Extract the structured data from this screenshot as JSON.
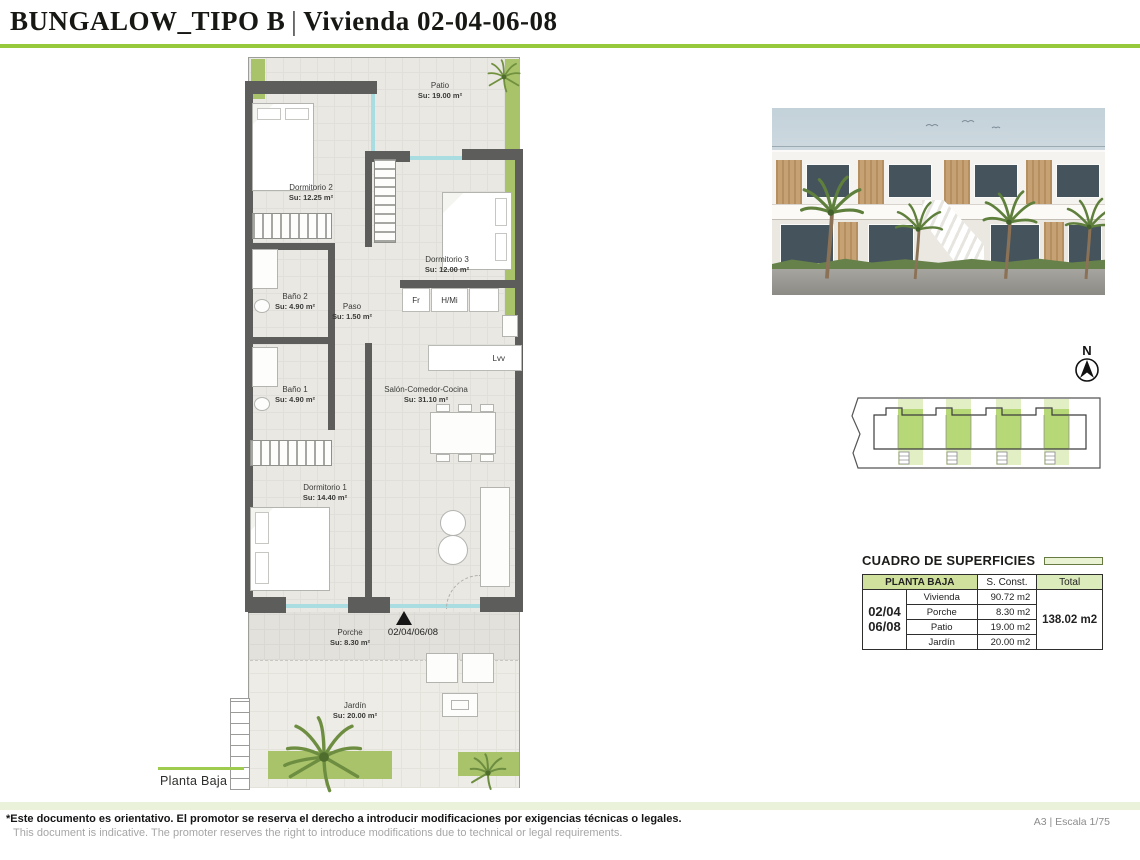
{
  "header": {
    "title_main": "BUNGALOW_TIPO B",
    "title_divider": "|",
    "title_sub": "Vivienda 02-04-06-08"
  },
  "plan": {
    "floor_label": "Planta Baja",
    "entrance_label": "02/04/06/08",
    "north_label": "N",
    "rooms": [
      {
        "name": "Patio",
        "area": "Su: 19.00 m²"
      },
      {
        "name": "Dormitorio 2",
        "area": "Su: 12.25 m²"
      },
      {
        "name": "Dormitorio 3",
        "area": "Su: 12.00 m²"
      },
      {
        "name": "Baño 2",
        "area": "Su: 4.90 m²"
      },
      {
        "name": "Paso",
        "area": "Su: 1.50 m²"
      },
      {
        "name": "Baño 1",
        "area": "Su: 4.90 m²"
      },
      {
        "name": "Salón-Comedor-Cocina",
        "area": "Su: 31.10 m²"
      },
      {
        "name": "Dormitorio 1",
        "area": "Su: 14.40 m²"
      },
      {
        "name": "Porche",
        "area": "Su: 8.30 m²"
      },
      {
        "name": "Jardín",
        "area": "Su: 20.00 m²"
      }
    ],
    "kitchen": {
      "fridge": "Fr",
      "oven_micro": "H/Mi",
      "dishwasher": "Lvv"
    }
  },
  "surfaces_table": {
    "title": "CUADRO DE SUPERFICIES",
    "header": {
      "floor": "PLANTA BAJA",
      "sconst": "S. Const.",
      "total": "Total"
    },
    "unit_line1": "02/04",
    "unit_line2": "06/08",
    "rows": [
      {
        "concept": "Vivienda",
        "value": "90.72 m2"
      },
      {
        "concept": "Porche",
        "value": "8.30 m2"
      },
      {
        "concept": "Patio",
        "value": "19.00 m2"
      },
      {
        "concept": "Jardín",
        "value": "20.00 m2"
      }
    ],
    "total_value": "138.02 m2"
  },
  "footer": {
    "disclaimer_es": "*Este documento es orientativo. El promotor se reserva el derecho a introducir modificaciones por exigencias técnicas o legales.",
    "disclaimer_en": "This document is indicative. The promoter reserves the right to introduce modifications due to technical or legal requirements.",
    "sheet_info": "A3 | Escala 1/75"
  },
  "colors": {
    "accent_green": "#97c93d",
    "table_header_green": "#cfe19c",
    "site_unit_green": "#b6d877",
    "wall_gray": "#5d5d5b"
  }
}
